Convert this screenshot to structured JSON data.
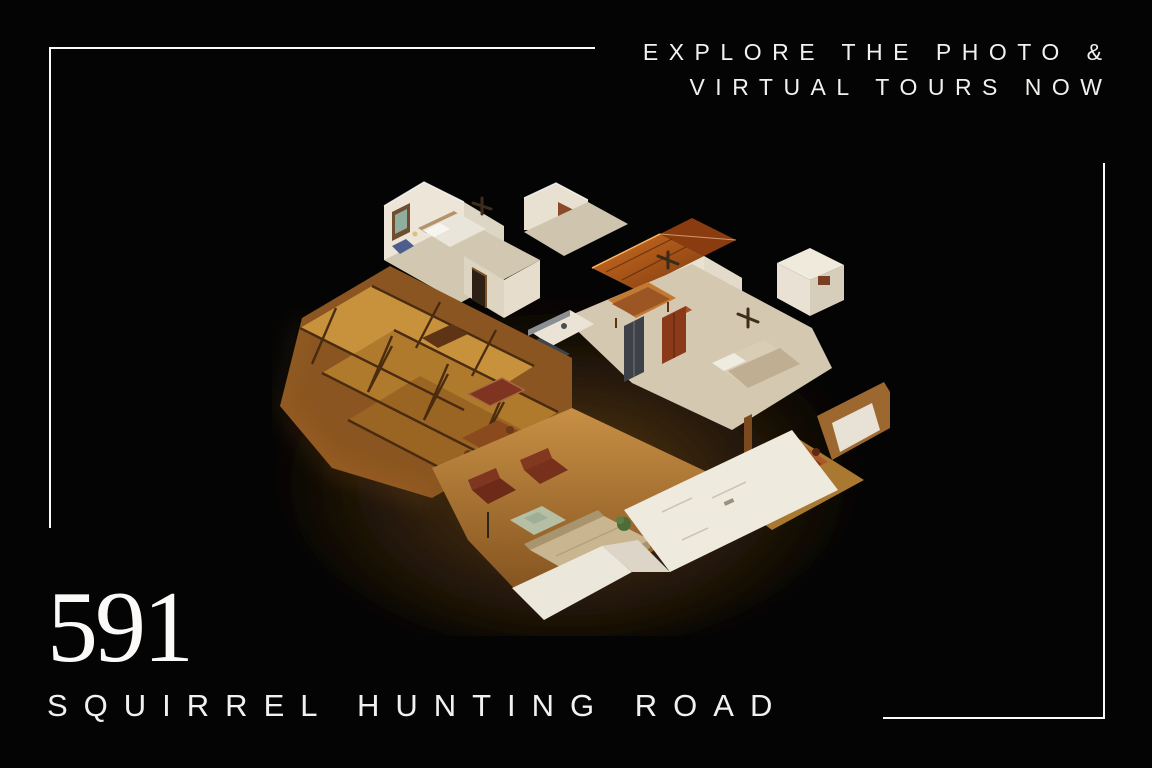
{
  "page": {
    "background_color": "#040404",
    "frame_color": "#fafafa",
    "text_color": "#f2f1ef"
  },
  "tagline": {
    "line1": "EXPLORE THE PHOTO &",
    "line2": "VIRTUAL TOURS NOW"
  },
  "hero_image": {
    "name": "3d-dollhouse-floor-plan",
    "description": "Isometric 3D dollhouse cutaway render of the home interior: wood-beamed cathedral rooms, white bedrooms with ceiling fans, red-wood vaulted foyer, kitchen island, dining and living areas with leather armchairs"
  },
  "address": {
    "number": "591",
    "street": "SQUIRREL HUNTING ROAD"
  },
  "palette": {
    "pine_wood": "#c8913c",
    "dark_beam": "#45280f",
    "vault_wood": "#b05618",
    "white_wall": "#ece5d8",
    "carpet": "#d2c7b1",
    "floor_wood": "#b5843c",
    "leather": "#6e2a18",
    "sofa": "#c9b691"
  }
}
